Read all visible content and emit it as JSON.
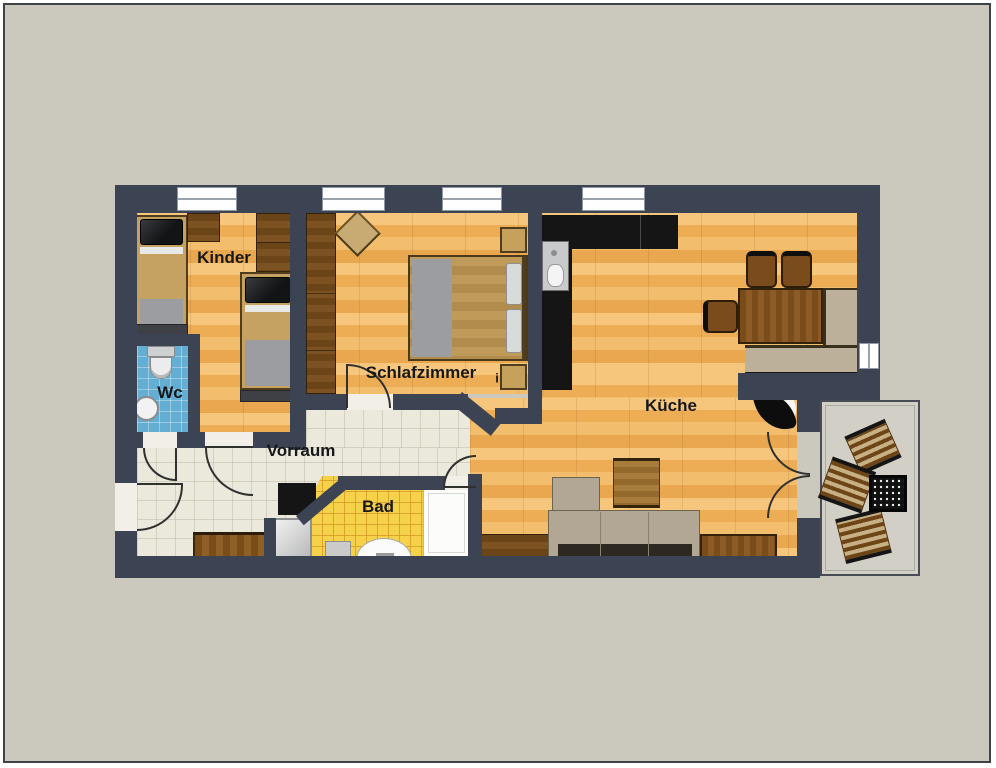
{
  "plan": {
    "type": "apartment-floor-plan",
    "rooms": {
      "kinder": "Kinder",
      "wc": "Wc",
      "schlafzimmer": "Schlafzimmer",
      "door_marker": "i",
      "vorraum": "Vorraum",
      "bad": "Bad",
      "kueche": "Küche"
    }
  },
  "palette": {
    "bg": "#cbc8bd",
    "wall": "#3c4352",
    "wood-floor": "#f1b867",
    "cream": "#ebe8dc",
    "yellow": "#f6d24a",
    "blue": "#63aed2",
    "balcony": "#d2cfc6",
    "blackf": "#151515",
    "beige": "#bdb09a",
    "wood-dark": "#6f4719",
    "wood-mid": "#7d4e1c",
    "label": "#17181a"
  }
}
